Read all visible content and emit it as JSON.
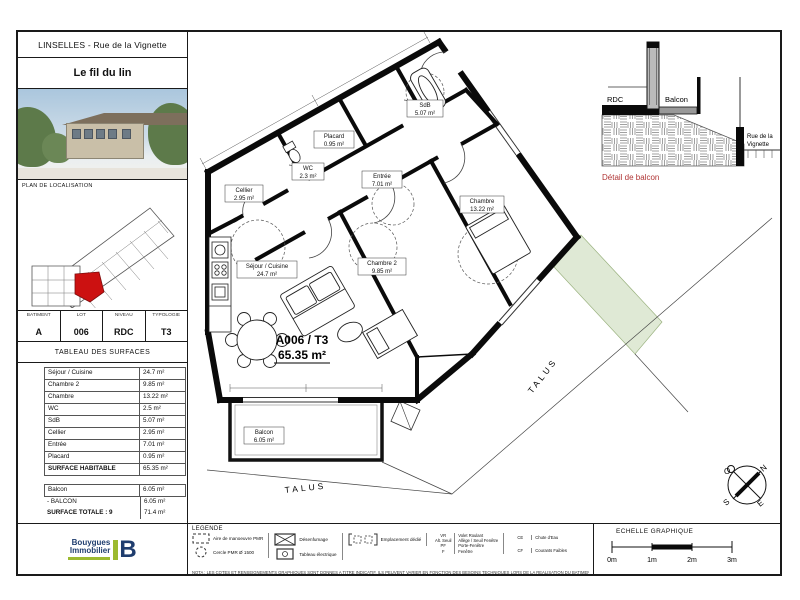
{
  "header": {
    "location": "LINSELLES - Rue de la Vignette",
    "program": "Le fil du lin",
    "localisation_title": "PLAN DE LOCALISATION"
  },
  "unit": {
    "headers": [
      "BATIMENT",
      "LOT",
      "NIVEAU",
      "TYPOLOGIE"
    ],
    "values": [
      "A",
      "006",
      "RDC",
      "T3"
    ]
  },
  "surfaces": {
    "title": "TABLEAU DES SURFACES",
    "rows": [
      [
        "Séjour / Cuisine",
        "24.7 m²"
      ],
      [
        "Chambre 2",
        "9.85 m²"
      ],
      [
        "Chambre",
        "13.22 m²"
      ],
      [
        "WC",
        "2.5 m²"
      ],
      [
        "SdB",
        "5.07 m²"
      ],
      [
        "Cellier",
        "2.95 m²"
      ],
      [
        "Entrée",
        "7.01 m²"
      ],
      [
        "Placard",
        "0.95 m²"
      ],
      [
        "SURFACE HABITABLE",
        "65.35 m²"
      ]
    ],
    "balcony_rows": [
      [
        "Balcon",
        "6.05 m²"
      ],
      [
        "- BALCON",
        "6.05 m²"
      ],
      [
        "SURFACE TOTALE : 9",
        "71.4 m²"
      ]
    ]
  },
  "plan": {
    "unit_code": "A006 / T3",
    "unit_area": "65.35 m²",
    "rooms": [
      {
        "name": "Cellier",
        "area": "2.95 m²"
      },
      {
        "name": "WC",
        "area": "2.3 m²"
      },
      {
        "name": "Placard",
        "area": "0.95 m²"
      },
      {
        "name": "SdB",
        "area": "5.07 m²"
      },
      {
        "name": "Entrée",
        "area": "7.01 m²"
      },
      {
        "name": "Chambre",
        "area": "13.22 m²"
      },
      {
        "name": "Chambre 2",
        "area": "9.85 m²"
      },
      {
        "name": "Séjour / Cuisine",
        "area": "24.7 m²"
      },
      {
        "name": "Balcon",
        "area": "6.05 m²"
      }
    ],
    "talus_1": "TALUS",
    "talus_2": "TALUS"
  },
  "detail": {
    "caption": "Détail de balcon",
    "rdc": "RDC",
    "balcon": "Balcon",
    "street_1": "Rue de la",
    "street_2": "Vignette"
  },
  "compass": {
    "n": "N",
    "s": "S",
    "e": "E",
    "o": "O"
  },
  "scalebar": {
    "title": "ECHELLE GRAPHIQUE",
    "ticks": [
      "0m",
      "1m",
      "2m",
      "3m"
    ]
  },
  "legend": {
    "title": "LEGENDE",
    "items": [
      {
        "label": "Aire de manoeuvre PMR"
      },
      {
        "label": "Cercle PMR Ø 1500"
      },
      {
        "label": "Désenfumage"
      },
      {
        "label": "Tableau électrique"
      },
      {
        "label": "Emplacement dédié"
      }
    ],
    "abbreviations": [
      [
        "VR",
        "Volet Roulant"
      ],
      [
        "Alt. Seuil",
        "Allège / Seuil Fenêtre"
      ],
      [
        "PF",
        "Porte-Fenêtre"
      ],
      [
        "F",
        "Fenêtre"
      ],
      [
        "CE",
        "Chute d'Eau"
      ],
      [
        "CF",
        "Courants Faibles"
      ]
    ],
    "nota": "NOTA : LES COTES ET RENSEIGNEMENTS GRAPHIQUES SONT DONNES A TITRE INDICATIF, ILS PEUVENT VARIER EN FONCTION DES BESOINS TECHNIQUES LORS DE LA REALISATION DU BATIMENT"
  },
  "logo": {
    "name_1": "Bouygues",
    "name_2": "Immobilier"
  },
  "colors": {
    "red_unit": "#cc1111",
    "red_caption": "#b03535",
    "green_area": "#dfe9d5",
    "logo_navy": "#1f3d6e",
    "logo_green": "#9cba2f"
  }
}
